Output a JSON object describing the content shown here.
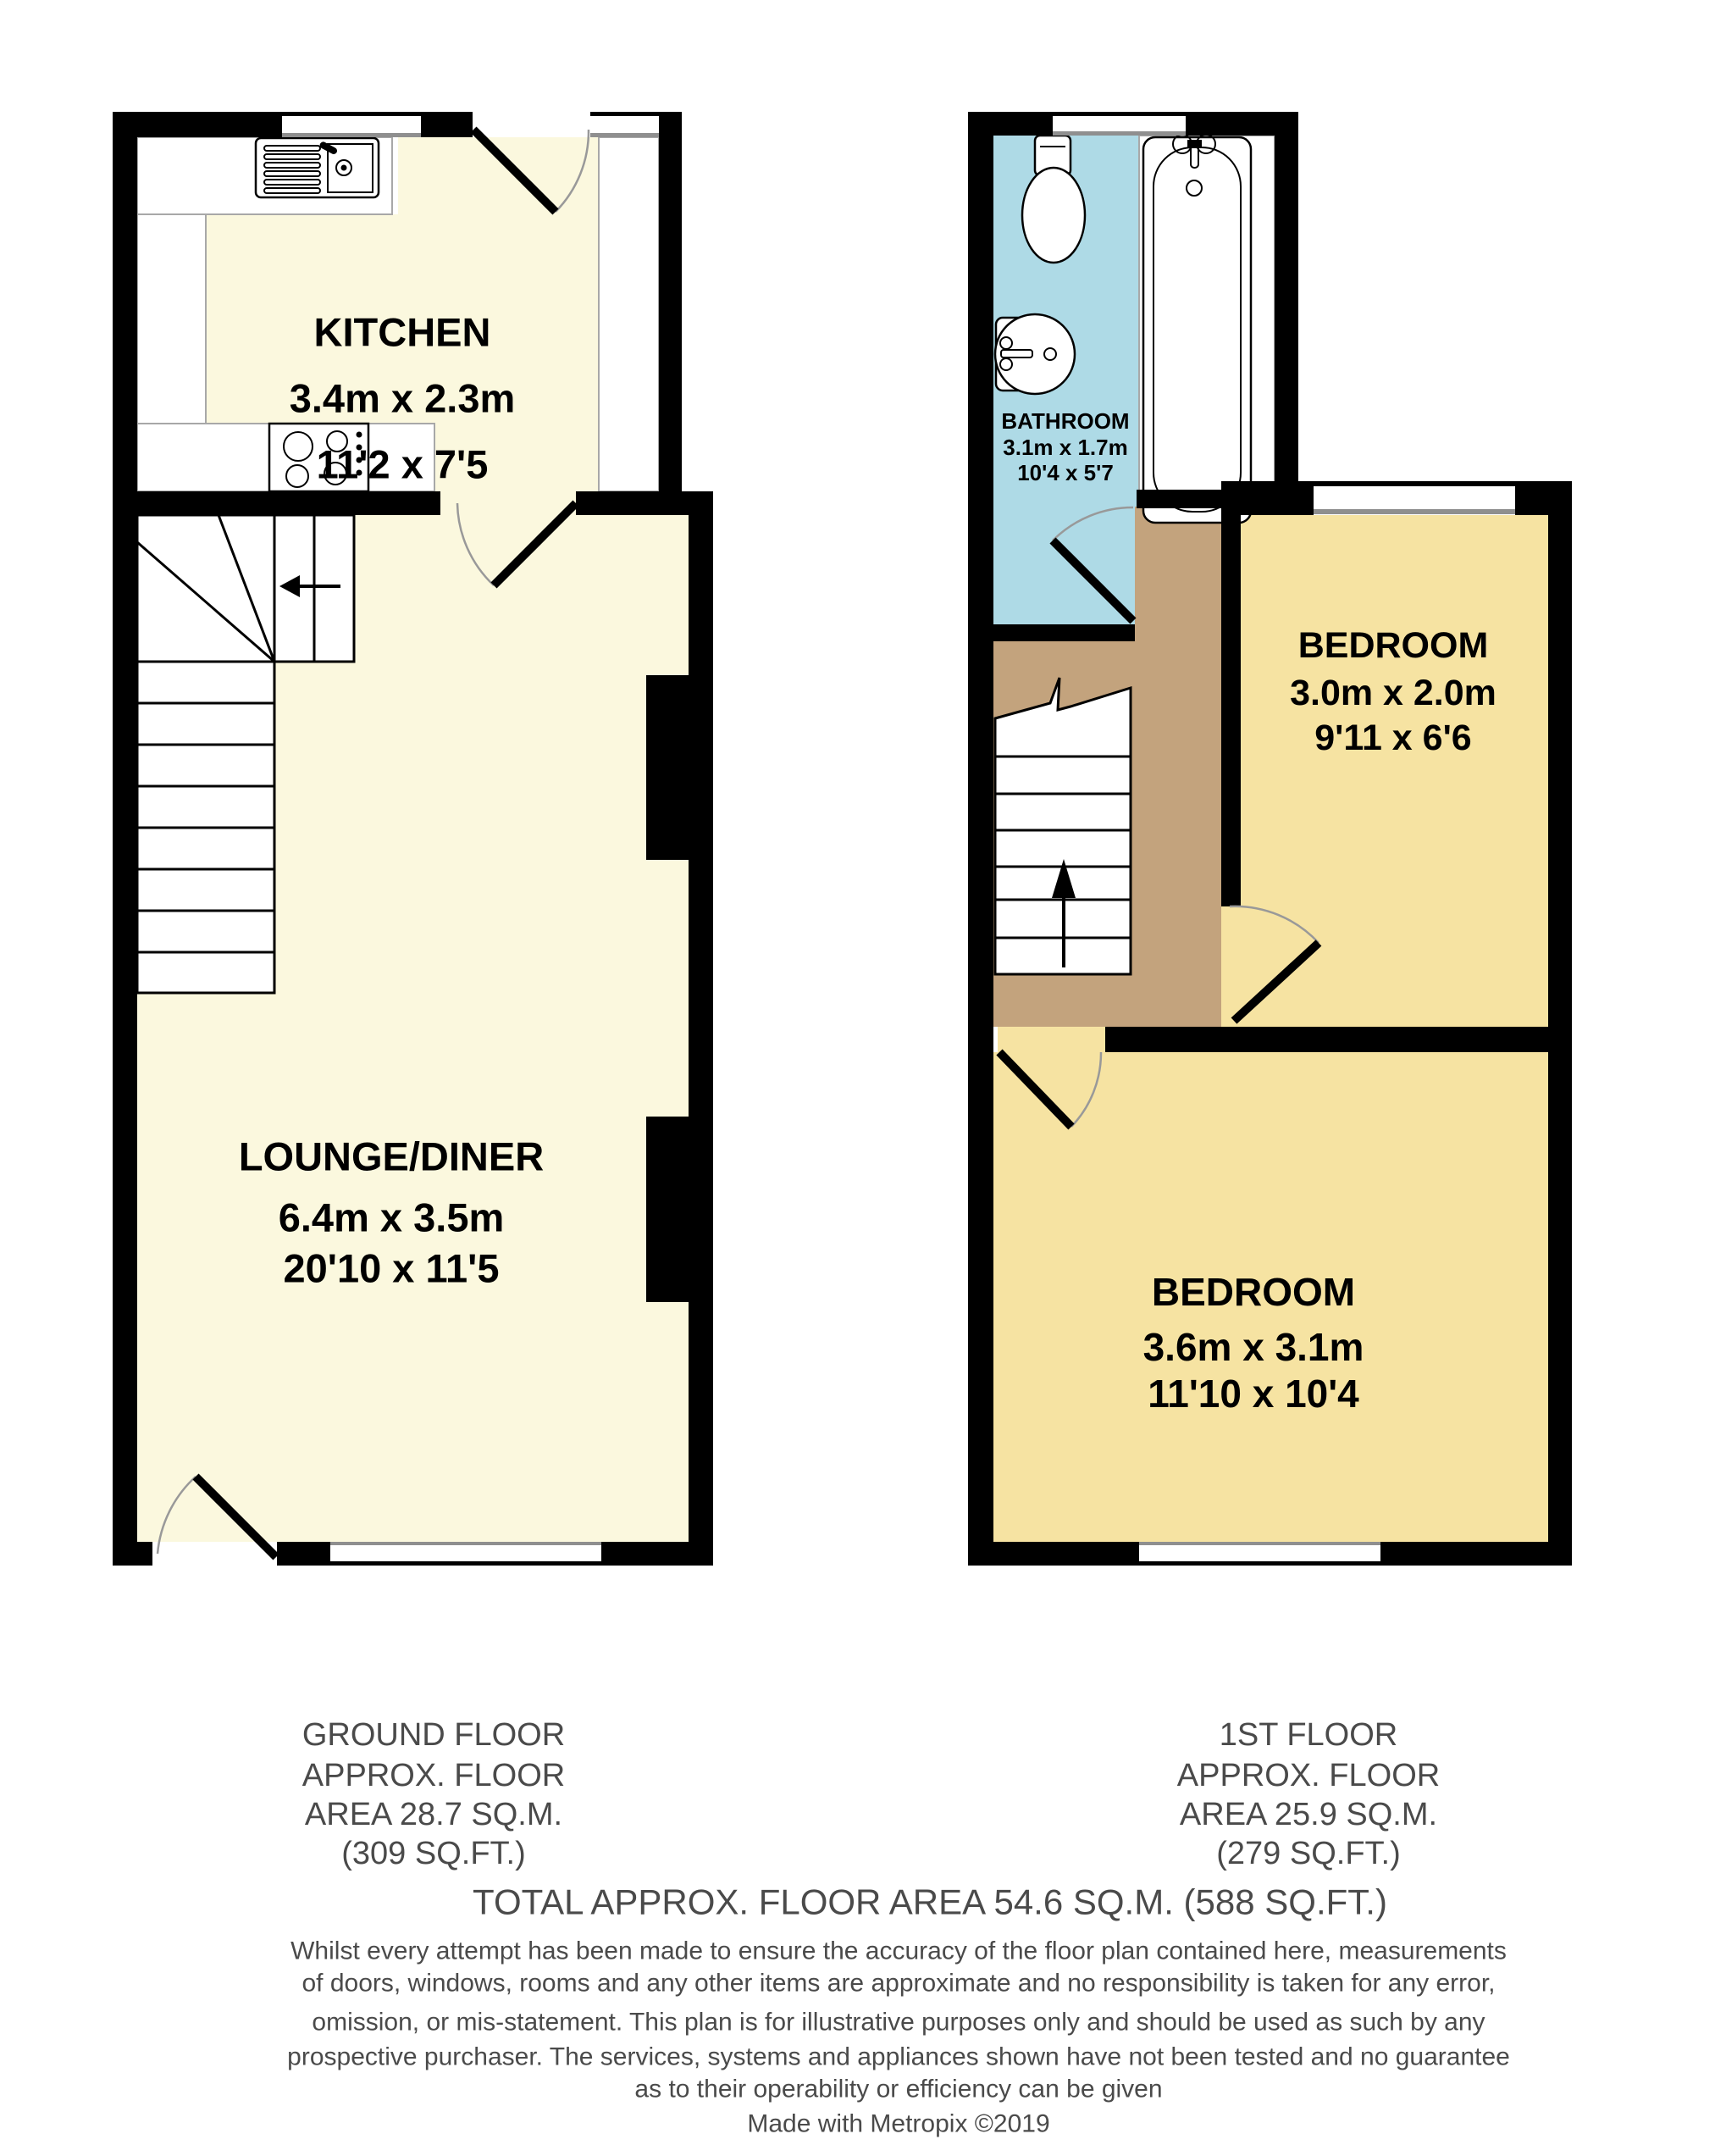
{
  "meta": {
    "type": "property-floorplan",
    "floors_shown": 2
  },
  "colors": {
    "wall": "#000000",
    "ground_floor_floor": "#FBF8DE",
    "bedroom_floor": "#F6E3A2",
    "bathroom_floor": "#AEDAE6",
    "landing_floor": "#C3A37D",
    "door_swing": "#999999",
    "footer_text": "#4A4A4A",
    "room_label_text": "#000000"
  },
  "rooms": {
    "kitchen": {
      "name": "KITCHEN",
      "metric": "3.4m x 2.3m",
      "imperial": "11'2 x 7'5"
    },
    "lounge": {
      "name": "LOUNGE/DINER",
      "metric": "6.4m x 3.5m",
      "imperial": "20'10 x 11'5"
    },
    "bathroom": {
      "name": "BATHROOM",
      "metric": "3.1m x 1.7m",
      "imperial": "10'4 x 5'7"
    },
    "bedroom1": {
      "name": "BEDROOM",
      "metric": "3.0m x 2.0m",
      "imperial": "9'11 x 6'6"
    },
    "bedroom2": {
      "name": "BEDROOM",
      "metric": "3.6m x 3.1m",
      "imperial": "11'10 x 10'4"
    }
  },
  "icons": {
    "sink": "sink-with-drainer-icon",
    "hob": "four-ring-hob-icon",
    "toilet": "toilet-icon",
    "basin": "wash-basin-icon",
    "bath": "bathtub-icon",
    "stairs_down_arrow": "stair-direction-arrow-left",
    "stairs_up_arrow": "stair-direction-arrow-up"
  },
  "footer": {
    "ground": {
      "line1": "GROUND FLOOR",
      "line2": "APPROX. FLOOR",
      "line3": "AREA 28.7 SQ.M.",
      "line4": "(309 SQ.FT.)"
    },
    "first": {
      "line1": "1ST FLOOR",
      "line2": "APPROX. FLOOR",
      "line3": "AREA 25.9 SQ.M.",
      "line4": "(279 SQ.FT.)"
    },
    "total": "TOTAL APPROX. FLOOR AREA 54.6 SQ.M. (588 SQ.FT.)",
    "disclaimer": [
      "Whilst every attempt has been made to ensure the accuracy of the floor plan contained here, measurements",
      "of doors, windows, rooms and any other items are approximate and no responsibility is taken for any error,",
      "omission, or mis-statement. This plan is for illustrative purposes only and should be used as such by any",
      "prospective purchaser. The services, systems and appliances shown have not been tested and no guarantee",
      "as to their operability or efficiency can be given"
    ],
    "credit": "Made with Metropix ©2019"
  }
}
